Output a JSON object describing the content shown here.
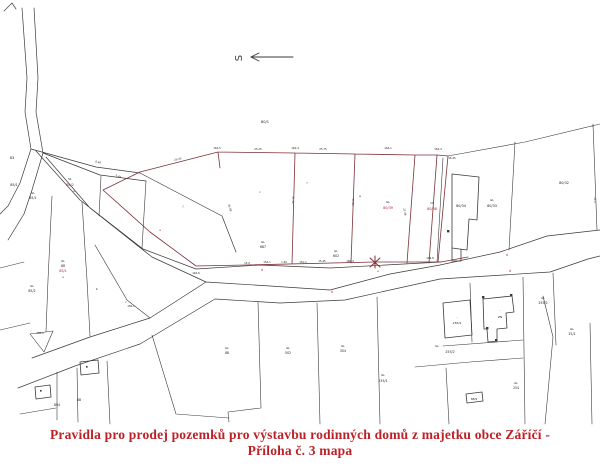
{
  "caption": {
    "line1": "Pravidla pro prodej pozemků pro výstavbu rodinných domů z majetku obce Záříčí -",
    "line2": "Příloha č. 3 mapa"
  },
  "north": {
    "label": "S"
  },
  "colors": {
    "boundary_line": "#3a3a3a",
    "highlight_line": "#7d3038",
    "highlight_text": "#b02832",
    "parcel_text": "#222222",
    "caption_text": "#bc2127"
  },
  "map": {
    "labels": [
      {
        "t": "83",
        "x": 12,
        "y": 159,
        "s": 3.4
      },
      {
        "t": "85/1",
        "x": 14,
        "y": 186,
        "s": 3.4
      },
      {
        "t": "GL",
        "x": 33,
        "y": 194,
        "s": 2.8
      },
      {
        "t": "85/1",
        "x": 33,
        "y": 199,
        "s": 3.2
      },
      {
        "t": "St.",
        "x": 70,
        "y": 180,
        "s": 2.8
      },
      {
        "t": "88/2",
        "x": 70,
        "y": 186,
        "c": "r",
        "s": 3.4
      },
      {
        "t": "e",
        "x": 74,
        "y": 192,
        "c": "r",
        "s": 3
      },
      {
        "t": "80/1",
        "x": 265,
        "y": 123,
        "s": 3.6
      },
      {
        "t": "j",
        "x": 183,
        "y": 207,
        "s": 3
      },
      {
        "t": "c",
        "x": 260,
        "y": 193,
        "s": 3
      },
      {
        "t": "e",
        "x": 360,
        "y": 197,
        "s": 3
      },
      {
        "t": "f",
        "x": 307,
        "y": 184,
        "c": "r",
        "s": 3
      },
      {
        "t": "a",
        "x": 160,
        "y": 231,
        "c": "r",
        "s": 3
      },
      {
        "t": "GL",
        "x": 263,
        "y": 243,
        "s": 2.8
      },
      {
        "t": "687",
        "x": 263,
        "y": 248,
        "s": 3.2
      },
      {
        "t": "GL",
        "x": 336,
        "y": 252,
        "s": 2.8
      },
      {
        "t": "602",
        "x": 336,
        "y": 257,
        "s": 3.2
      },
      {
        "t": "GL",
        "x": 388,
        "y": 203,
        "s": 2.8
      },
      {
        "t": "80/39",
        "x": 388,
        "y": 209,
        "c": "r",
        "s": 3.4
      },
      {
        "t": "1C",
        "x": 432,
        "y": 204,
        "s": 2.8
      },
      {
        "t": "80/38",
        "x": 432,
        "y": 210,
        "c": "r",
        "s": 3.4
      },
      {
        "t": "80/34",
        "x": 461,
        "y": 207,
        "s": 3.4
      },
      {
        "t": "GL",
        "x": 492,
        "y": 201,
        "s": 2.8
      },
      {
        "t": "80/33",
        "x": 492,
        "y": 207,
        "s": 3.4
      },
      {
        "t": "80/32",
        "x": 564,
        "y": 184,
        "s": 3.4
      },
      {
        "t": "GL",
        "x": 63,
        "y": 262,
        "s": 2.8
      },
      {
        "t": "88",
        "x": 63,
        "y": 267,
        "s": 3.2
      },
      {
        "t": "85/1",
        "x": 63,
        "y": 272,
        "c": "r",
        "s": 3.4
      },
      {
        "t": "e",
        "x": 63,
        "y": 278,
        "c": "r",
        "s": 3
      },
      {
        "t": "GL",
        "x": 32,
        "y": 287,
        "s": 2.8
      },
      {
        "t": "85/2",
        "x": 32,
        "y": 292,
        "s": 3.2
      },
      {
        "t": "b",
        "x": 97,
        "y": 290,
        "s": 3
      },
      {
        "t": "c",
        "x": 126,
        "y": 303,
        "s": 3
      },
      {
        "t": "d",
        "x": 262,
        "y": 271,
        "c": "r",
        "s": 3.2
      },
      {
        "t": "d",
        "x": 332,
        "y": 293,
        "c": "r",
        "s": 3.2
      },
      {
        "t": "e",
        "x": 378,
        "y": 272,
        "c": "r",
        "s": 3
      },
      {
        "t": "d",
        "x": 507,
        "y": 256,
        "c": "r",
        "s": 3.2
      },
      {
        "t": "d",
        "x": 510,
        "y": 272,
        "c": "r",
        "s": 3.2
      },
      {
        "t": "88",
        "x": 79,
        "y": 401,
        "s": 3.2
      },
      {
        "t": "894",
        "x": 57,
        "y": 406,
        "s": 3.2
      },
      {
        "t": "GL",
        "x": 227,
        "y": 349,
        "s": 2.8
      },
      {
        "t": "88",
        "x": 227,
        "y": 354,
        "s": 3.2
      },
      {
        "t": "GL",
        "x": 288,
        "y": 349,
        "s": 2.8
      },
      {
        "t": "502",
        "x": 288,
        "y": 354,
        "s": 3.2
      },
      {
        "t": "GL",
        "x": 343,
        "y": 347,
        "s": 2.8
      },
      {
        "t": "504",
        "x": 343,
        "y": 352,
        "s": 3.2
      },
      {
        "t": "GL",
        "x": 383,
        "y": 376,
        "s": 2.8
      },
      {
        "t": "235/1",
        "x": 383,
        "y": 382,
        "s": 3.2
      },
      {
        "t": "GL",
        "x": 437,
        "y": 347,
        "s": 2.8
      },
      {
        "t": "255/2",
        "x": 450,
        "y": 353,
        "s": 3.2
      },
      {
        "t": "·",
        "x": 457,
        "y": 319,
        "s": 3.4
      },
      {
        "t": "255/4",
        "x": 457,
        "y": 324,
        "s": 3
      },
      {
        "t": "·",
        "x": 500,
        "y": 312,
        "s": 3.4
      },
      {
        "t": "ZN",
        "x": 500,
        "y": 318,
        "s": 3
      },
      {
        "t": "GL",
        "x": 543,
        "y": 299,
        "s": 2.8
      },
      {
        "t": "255/2",
        "x": 543,
        "y": 304,
        "s": 3.2
      },
      {
        "t": "GL",
        "x": 516,
        "y": 384,
        "s": 2.8
      },
      {
        "t": "254",
        "x": 516,
        "y": 389,
        "s": 3.2
      },
      {
        "t": "GL",
        "x": 572,
        "y": 330,
        "s": 2.8
      },
      {
        "t": "25/1",
        "x": 572,
        "y": 335,
        "s": 3.2
      },
      {
        "t": "88/9",
        "x": 474,
        "y": 400,
        "s": 2.8
      },
      {
        "t": "8.48",
        "x": 98,
        "y": 163,
        "s": 2.6,
        "r": 12
      },
      {
        "t": "5.45",
        "x": 118,
        "y": 177,
        "s": 2.6,
        "r": 22
      },
      {
        "t": "25.45",
        "x": 178,
        "y": 160,
        "s": 2.6,
        "r": -13
      },
      {
        "t": "164-5",
        "x": 217,
        "y": 149,
        "s": 2.6
      },
      {
        "t": "25.25",
        "x": 258,
        "y": 150,
        "s": 2.6
      },
      {
        "t": "164-4",
        "x": 295,
        "y": 149,
        "s": 2.6
      },
      {
        "t": "25.75",
        "x": 323,
        "y": 150,
        "s": 2.6
      },
      {
        "t": "164-1",
        "x": 388,
        "y": 149,
        "s": 2.6
      },
      {
        "t": "164-4",
        "x": 438,
        "y": 150,
        "s": 2.6
      },
      {
        "t": "16.45",
        "x": 452,
        "y": 159,
        "s": 2.6
      },
      {
        "t": "15.0",
        "x": 247,
        "y": 264,
        "s": 2.6
      },
      {
        "t": "154-1",
        "x": 267,
        "y": 263,
        "s": 2.6
      },
      {
        "t": "1.40",
        "x": 284,
        "y": 263,
        "s": 2.6
      },
      {
        "t": "151-1",
        "x": 303,
        "y": 263,
        "s": 2.6
      },
      {
        "t": "15.45",
        "x": 322,
        "y": 262,
        "s": 2.6
      },
      {
        "t": "166-4",
        "x": 350,
        "y": 262,
        "s": 2.6
      },
      {
        "t": "164-8",
        "x": 430,
        "y": 259,
        "s": 2.6
      },
      {
        "t": "156-1",
        "x": 131,
        "y": 307,
        "s": 2.6
      },
      {
        "t": "158-2",
        "x": 40,
        "y": 334,
        "s": 2.6
      },
      {
        "t": "164-6",
        "x": 196,
        "y": 274,
        "s": 2.6
      },
      {
        "t": "37.12",
        "x": 292,
        "y": 200,
        "s": 2.6,
        "r": 90
      },
      {
        "t": "37.85",
        "x": 352,
        "y": 202,
        "s": 2.6,
        "r": 90
      },
      {
        "t": "21.48",
        "x": 404,
        "y": 212,
        "s": 2.6,
        "r": 78
      },
      {
        "t": "25.48",
        "x": 229,
        "y": 208,
        "s": 2.6,
        "r": 72
      },
      {
        "t": "21.0",
        "x": 594,
        "y": 200,
        "s": 2.6,
        "r": 90
      }
    ]
  }
}
